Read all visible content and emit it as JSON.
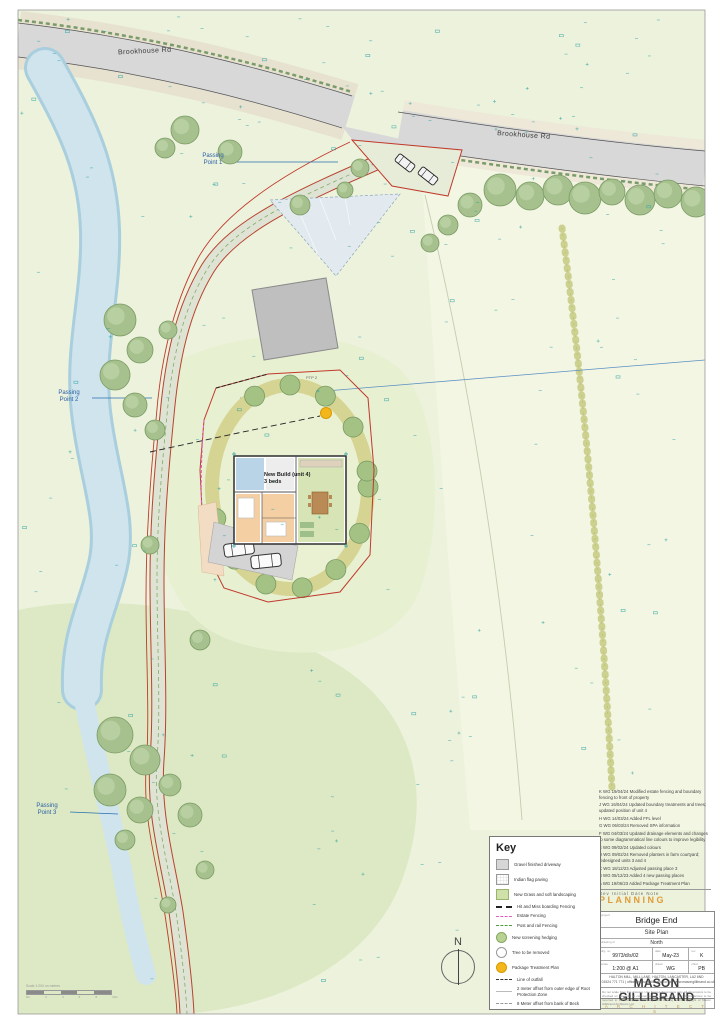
{
  "map_labels": {
    "road_label_1": "Brookhouse Rd",
    "road_label_2": "Brookhouse Rd",
    "passing_point_1": "Passing\nPoint 1",
    "passing_point_2": "Passing\nPoint 2",
    "passing_point_3": "Passing\nPoint 3",
    "new_build": "New Build (unit 4)\n3 beds",
    "ptp": "PTP 2"
  },
  "key": {
    "title": "Key",
    "items": [
      {
        "label": "Gravel finished driveway"
      },
      {
        "label": "Indian flag paving"
      },
      {
        "label": "New Grass and soft landscaping"
      },
      {
        "label": "Hit and Miss boarding Fencing"
      },
      {
        "label": "Estate Fencing"
      },
      {
        "label": "Post and rail Fencing"
      },
      {
        "label": "New screening hedging"
      },
      {
        "label": "Tree to be removed"
      },
      {
        "label": "Package Treatment Plan"
      },
      {
        "label": "Line of outfall"
      },
      {
        "label": "2 meter offset from outer edge of Root Protection Zone"
      },
      {
        "label": "8 Meter offset from bank of Beck"
      }
    ]
  },
  "revisions": {
    "entries": [
      "K  WG  19/04/24  Modified estate fencing and boundary fencing to front of property",
      "J  WG  16/04/24  Updated boundary treatments and trees; updated position of unit 4",
      "H  WG  14/03/24  Added FFL level",
      "G  WG  06/03/24  Removed SPA information",
      "F  WG  04/03/24  Updated drainage elements and changes to some diagrammatical line colours to improve legibility",
      "E  WG  09/02/24  Updated colours",
      "D  WG  09/02/24  Removed planters in farm courtyard; redesigned units 3 and 4",
      "C  WG  18/12/23  Adjusted passing place 3",
      "B  WG  05/12/23  Added 4 new passing places",
      "A  WG  19/06/23  Added Package Treatment Plan"
    ],
    "footer": "Rev   Initial   Date   Note"
  },
  "status_stamp": "PLANNING",
  "title_block": {
    "project_label": "project",
    "project": "Bridge End",
    "drawing_title": "Site Plan",
    "orientation_label": "drawing of",
    "orientation": "North",
    "drg_no_label": "drg. no",
    "drg_no": "9973/d/s/02",
    "date_label": "date",
    "date": "May-23",
    "rev_label": "rev",
    "rev": "K",
    "scale_label": "scale",
    "scale": "1:200 @ A1",
    "drawn_label": "drawn",
    "drawn": "WG",
    "checked_label": "chkd",
    "checked": "PB",
    "brand": "MASON GILLIBRAND",
    "brand_sub": "A R C H I T E C T S",
    "address": "HALTON MILL, MILL LANE, HALTON, LANCASTER, LA2 6ND",
    "contact": "T: 01524 771 771  |  office@masongillibrand.co.uk  |  www.masongillibrand.co.uk",
    "disclaimer": "Do not scale from this drawing. Use figured dimensions only. All dimensions to be checked on site prior to commencement of any work. Any discrepancies to be reported to the architect immediately. This drawing is the copyright of Mason Gillibrand Architects Ltd."
  },
  "north_label": "N",
  "scale_bar": {
    "caption": "Scale 1:200 on metres",
    "ticks": [
      "0m",
      "2",
      "4",
      "6",
      "8",
      "10m"
    ]
  },
  "colors": {
    "boundary_red": "#c0392b",
    "planning_orange": "#e09c3a",
    "survey_teal": "#2aa0a0",
    "river_blue": "#cfe4ed",
    "ptp_yellow": "#f3b71b",
    "estate_fence_pink": "#e060c0"
  }
}
